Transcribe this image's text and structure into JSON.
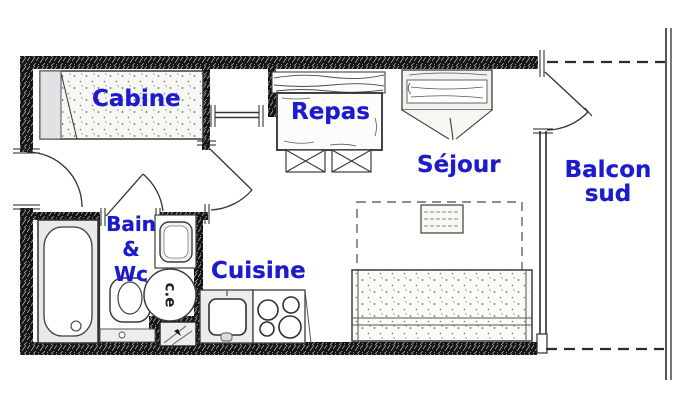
{
  "plan_title": "Studio apartment floor plan",
  "colors": {
    "room_label": "#1c1ccd",
    "wall": "#111111",
    "line": "#3a3a3a"
  },
  "rooms": {
    "cabine": {
      "label": "Cabine"
    },
    "repas": {
      "label": "Repas"
    },
    "sejour": {
      "label": "Séjour"
    },
    "balcon": {
      "line1": "Balcon",
      "line2": "sud"
    },
    "bain_wc": {
      "line1": "Bain",
      "line2": "&",
      "line3": "Wc"
    },
    "cuisine": {
      "label": "Cuisine"
    }
  },
  "fixtures": {
    "water_heater": {
      "label": "c.e"
    }
  }
}
